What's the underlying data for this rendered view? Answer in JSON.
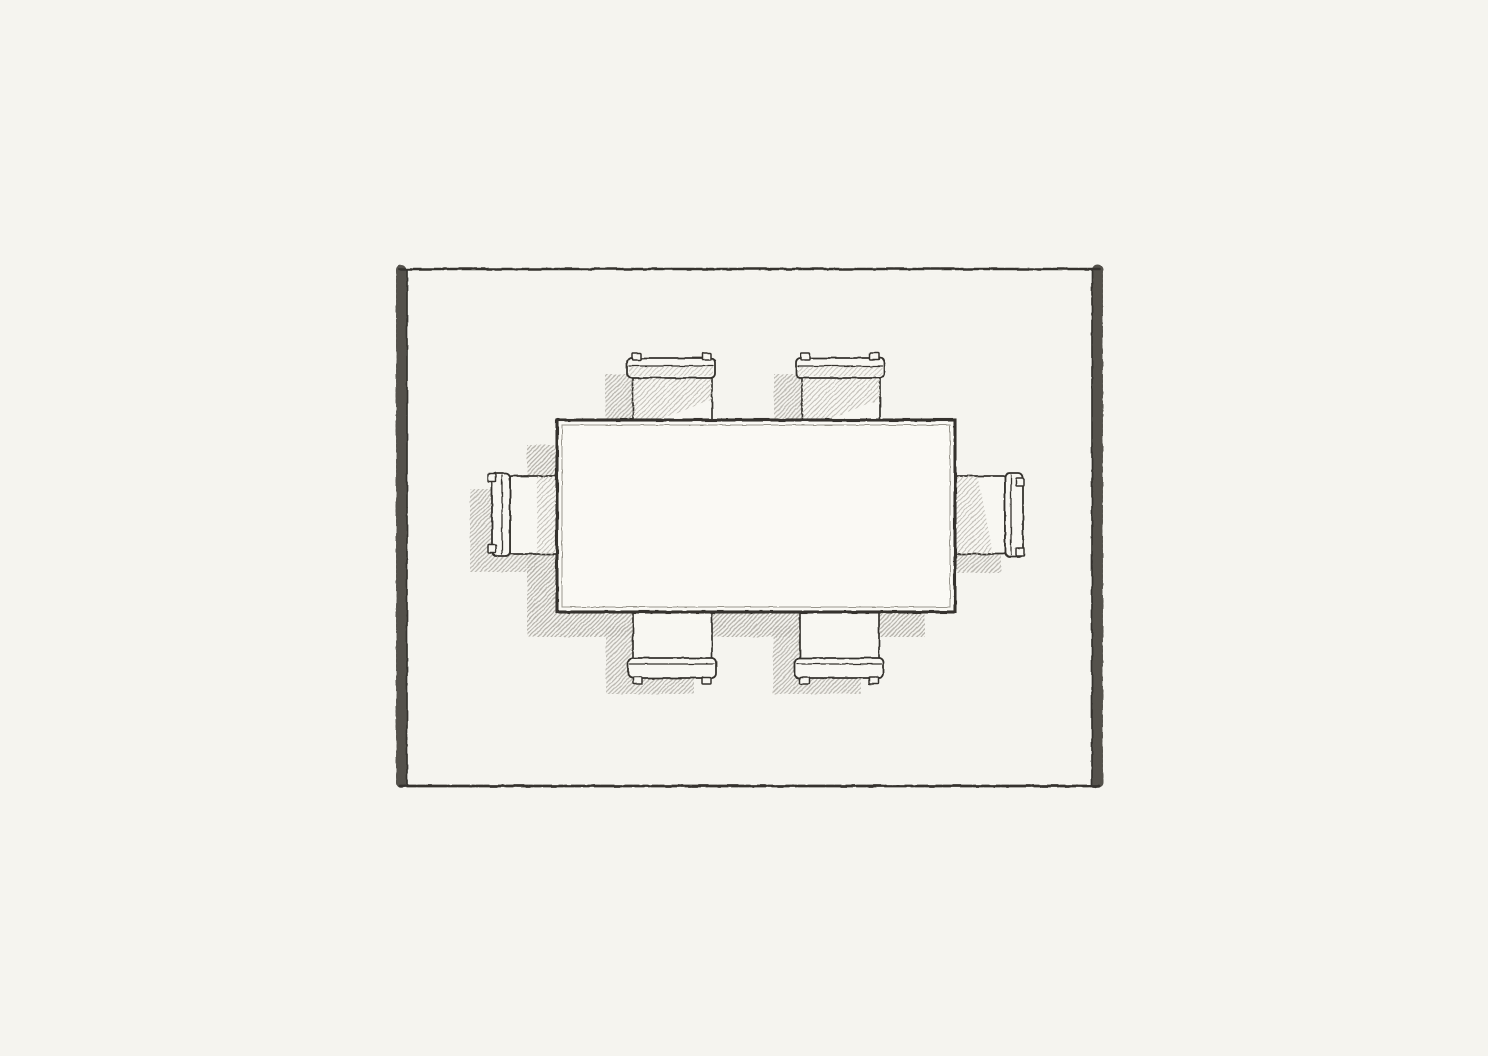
{
  "meta": {
    "description": "Plan-view pencil sketch of a rectangular six-seat dining table centered on a fringed area rug",
    "chair_count": 6
  },
  "canvas": {
    "width": 1488,
    "height": 1056,
    "background": "#f5f4ef"
  },
  "palette": {
    "ink": "#35332e",
    "ink_soft": "#7d7a72",
    "paper": "#f5f4ef",
    "table_fill": "#faf9f4",
    "chair_fill": "#f8f7f2",
    "hatch_strong": "#b2afa8",
    "hatch_soft": "#c6c3bc",
    "fringe": "#45433e",
    "hairline": "#9a978e"
  },
  "rug": {
    "x": 407,
    "y": 269,
    "w": 685,
    "h": 517,
    "fringe_sides": [
      "left",
      "right"
    ],
    "fringe_len": 11
  },
  "table": {
    "x": 557,
    "y": 420,
    "w": 398,
    "h": 192,
    "shadow_dx": -30,
    "shadow_dy": 25
  },
  "chair_shadow_offset": {
    "dx": -22,
    "dy": 16
  },
  "chairs": [
    {
      "id": "chair-top-left",
      "side": "top",
      "seat": [
        633,
        377,
        79,
        45
      ],
      "back": [
        627,
        358,
        88,
        20
      ],
      "finials": [
        [
          632,
          353,
          9,
          7
        ],
        [
          702,
          353,
          9,
          7
        ]
      ]
    },
    {
      "id": "chair-top-right",
      "side": "top",
      "seat": [
        802,
        377,
        78,
        45
      ],
      "back": [
        796,
        358,
        88,
        20
      ],
      "finials": [
        [
          801,
          353,
          9,
          7
        ],
        [
          870,
          353,
          9,
          7
        ]
      ]
    },
    {
      "id": "chair-left",
      "side": "left",
      "seat": [
        510,
        476,
        49,
        78
      ],
      "back": [
        492,
        473,
        18,
        83
      ],
      "finials": [
        [
          488,
          474,
          8,
          8
        ],
        [
          488,
          545,
          8,
          8
        ]
      ]
    },
    {
      "id": "chair-right",
      "side": "right",
      "seat": [
        951,
        476,
        54,
        78
      ],
      "back": [
        1005,
        473,
        18,
        84
      ],
      "finials": [
        [
          1016,
          478,
          8,
          8
        ],
        [
          1016,
          548,
          8,
          8
        ]
      ]
    },
    {
      "id": "chair-bottom-left",
      "side": "bottom",
      "seat": [
        633,
        610,
        79,
        50
      ],
      "back": [
        628,
        658,
        88,
        20
      ],
      "finials": [
        [
          633,
          677,
          9,
          7
        ],
        [
          702,
          677,
          9,
          7
        ]
      ]
    },
    {
      "id": "chair-bottom-right",
      "side": "bottom",
      "seat": [
        800,
        610,
        79,
        50
      ],
      "back": [
        795,
        658,
        88,
        20
      ],
      "finials": [
        [
          800,
          677,
          9,
          7
        ],
        [
          869,
          677,
          9,
          7
        ]
      ]
    }
  ]
}
